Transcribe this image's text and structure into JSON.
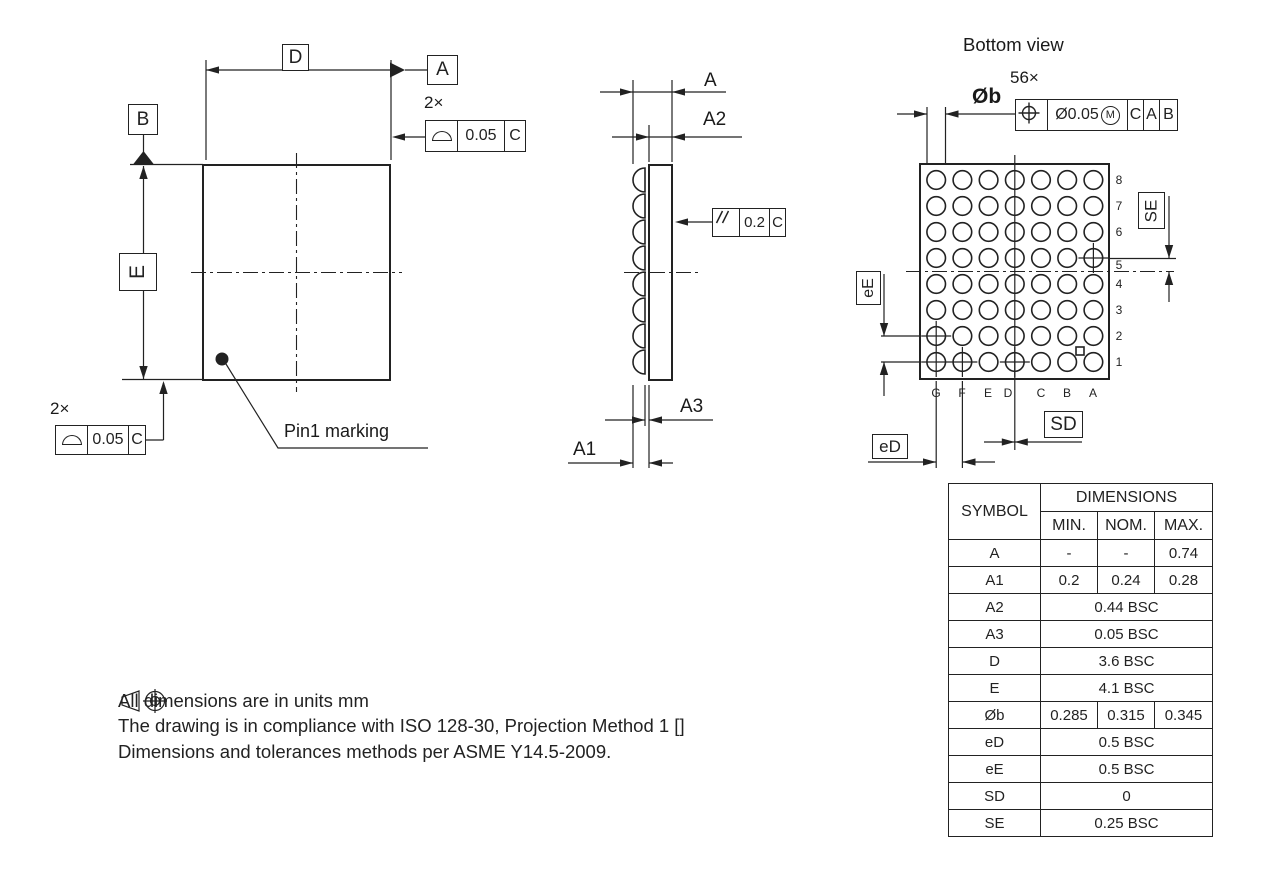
{
  "top_view": {
    "dim_d": "D",
    "datum_a": "A",
    "datum_b": "B",
    "dim_e": "E",
    "qty_upper": "2×",
    "fcf_upper_tol": "0.05",
    "fcf_upper_datum": "C",
    "qty_lower": "2×",
    "fcf_lower_tol": "0.05",
    "fcf_lower_datum": "C",
    "pin1_label": "Pin1 marking"
  },
  "side_view": {
    "dim_a": "A",
    "dim_a2": "A2",
    "dim_a3": "A3",
    "dim_a1": "A1",
    "parallelism_tol": "0.2",
    "parallelism_datum": "C"
  },
  "bottom_view": {
    "title": "Bottom view",
    "ball_count": "56×",
    "dim_ball": "Øb",
    "position_tol": "Ø0.05",
    "mmc_modifier": "M",
    "datum_1": "C",
    "datum_2": "A",
    "datum_3": "B",
    "dim_se": "SE",
    "dim_ee": "eE",
    "dim_ed": "eD",
    "dim_sd": "SD",
    "row_labels": [
      "8",
      "7",
      "6",
      "5",
      "4",
      "3",
      "2",
      "1"
    ],
    "col_labels": [
      "G",
      "F",
      "E",
      "D",
      "C",
      "B",
      "A"
    ]
  },
  "table": {
    "header": {
      "symbol": "SYMBOL",
      "dimensions": "DIMENSIONS",
      "min": "MIN.",
      "nom": "NOM.",
      "max": "MAX."
    },
    "rows": [
      {
        "symbol": "A",
        "min": "-",
        "nom": "-",
        "max": "0.74"
      },
      {
        "symbol": "A1",
        "min": "0.2",
        "nom": "0.24",
        "max": "0.28"
      },
      {
        "symbol": "A2",
        "merged": "0.44 BSC"
      },
      {
        "symbol": "A3",
        "merged": "0.05 BSC"
      },
      {
        "symbol": "D",
        "merged": "3.6 BSC"
      },
      {
        "symbol": "E",
        "merged": "4.1 BSC"
      },
      {
        "symbol": "Øb",
        "min": "0.285",
        "nom": "0.315",
        "max": "0.345"
      },
      {
        "symbol": "eD",
        "merged": "0.5 BSC"
      },
      {
        "symbol": "eE",
        "merged": "0.5 BSC"
      },
      {
        "symbol": "SD",
        "merged": "0"
      },
      {
        "symbol": "SE",
        "merged": "0.25 BSC"
      }
    ]
  },
  "notes": {
    "line1": "All dimensions are in units mm",
    "line2_prefix": "The drawing is in compliance with ISO 128-30, Projection Method 1 [",
    "line2_suffix": "]",
    "line3": "Dimensions and tolerances methods per ASME Y14.5-2009."
  },
  "icons": {
    "position-icon": "true-position circle with crosshair",
    "profile-of-surface-icon": "closed semicircle",
    "parallelism-icon": "two parallel slanted lines",
    "mmc-icon": "circled M",
    "datum-triangle-icon": "filled triangle",
    "pin1-dot-icon": "filled circle",
    "first-angle-projection-icon": "truncated cone and target circle"
  },
  "colors": {
    "line": "#222222",
    "background": "#ffffff"
  }
}
